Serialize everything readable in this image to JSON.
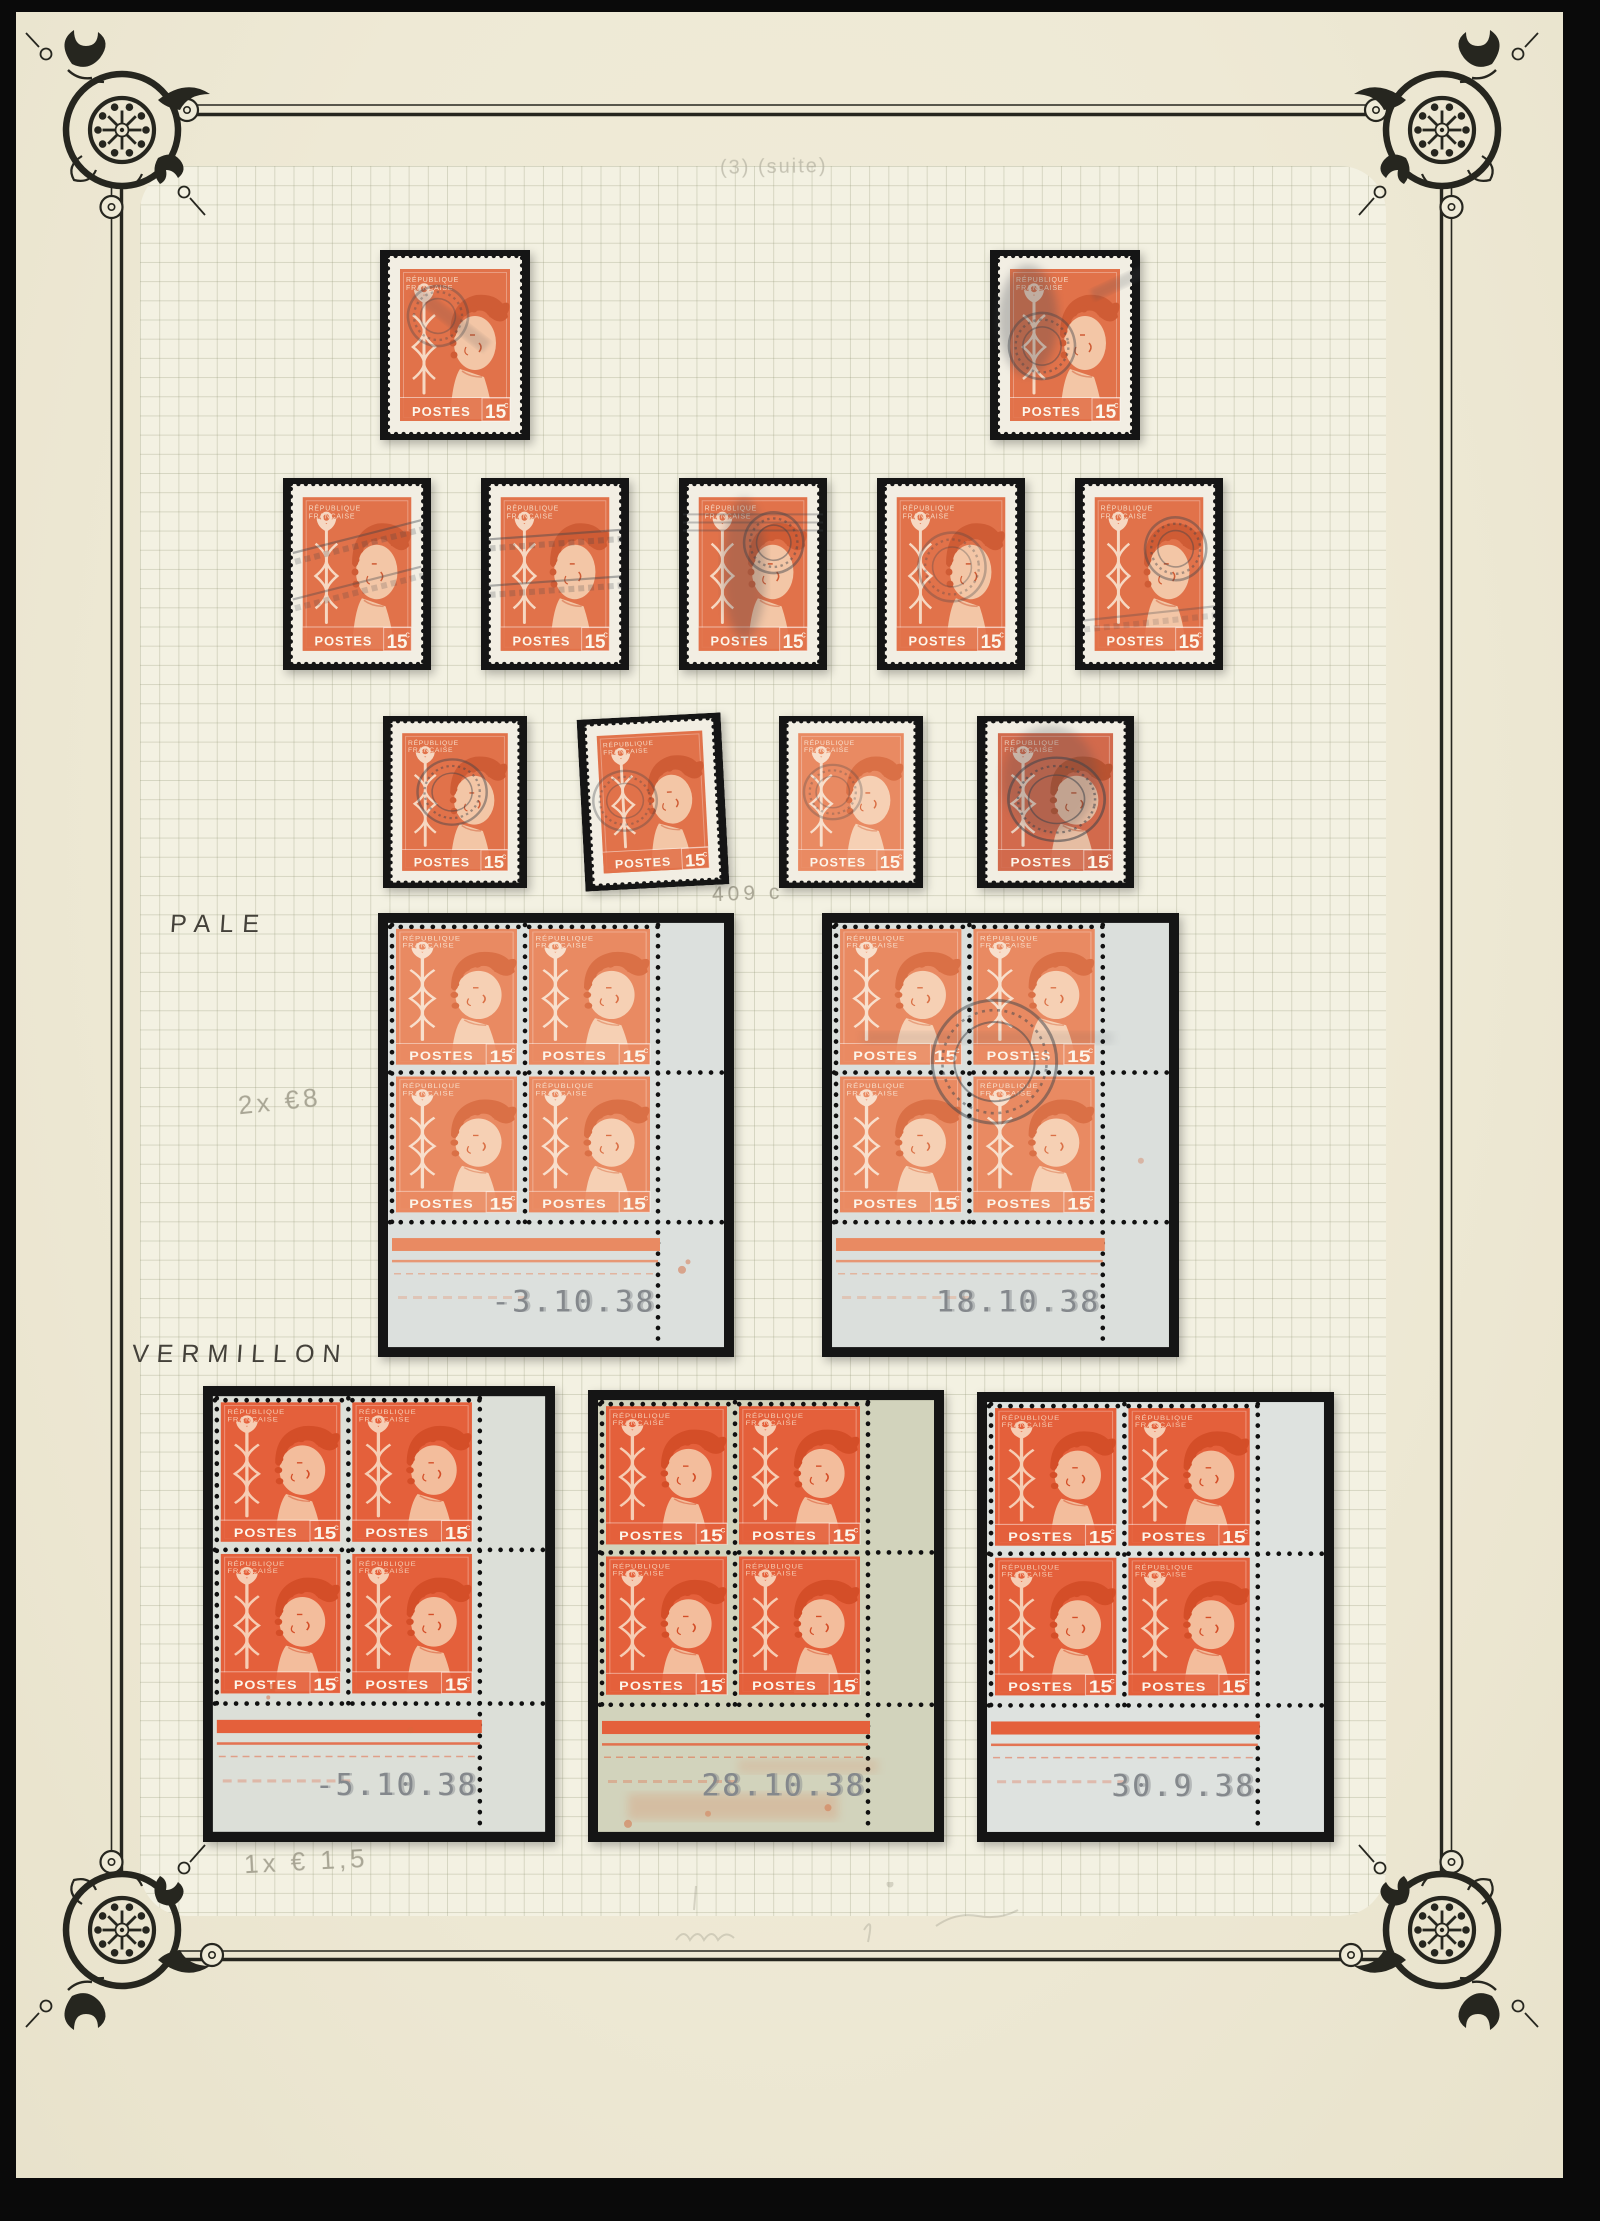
{
  "album": {
    "notes": {
      "top": "(3) (suite)",
      "catalog": "409 c",
      "pale_label": "PALE",
      "pale_price": "2x €8",
      "vermillon_label": "VERMILLON",
      "vermillon_price": "1x € 1,5"
    },
    "stamp_face": {
      "country1": "RÉPUBLIQUE",
      "country2": "FRANÇAISE",
      "postes": "POSTES",
      "value": "15",
      "unit": "c"
    },
    "colors": {
      "page": "#eeead7",
      "grid_paper": "#f3f1e2",
      "grid_line": "#c9c5ae",
      "mount": "#151515",
      "ink": "#26261f",
      "date_gray": "#84888c",
      "pencil": "#a19e8d",
      "single_paper": "#f2eee3",
      "shades": {
        "pale": {
          "o": "#e98a62",
          "l": "#f8dfcc",
          "s": "#f6d0b4",
          "d": "#da7046"
        },
        "normal": {
          "o": "#e1724a",
          "l": "#f6d8c2",
          "s": "#f3c6a6",
          "d": "#cf5c35"
        },
        "verm": {
          "o": "#e4603b",
          "l": "#f6cdb4",
          "s": "#f3bd9c",
          "d": "#d44e28"
        },
        "deep": {
          "o": "#d26a4c",
          "l": "#ead0be",
          "s": "#e6bda2",
          "d": "#b85331"
        }
      }
    },
    "singles": [
      {
        "x": 380,
        "y": 250,
        "w": 150,
        "h": 190,
        "shade": "normal",
        "tilt": 0,
        "cancels": [
          {
            "k": "cds",
            "x": 58,
            "y": 66,
            "r": 30,
            "o": 0.33,
            "rot": -20
          },
          {
            "k": "streak",
            "x": 40,
            "y": 36,
            "w": 90,
            "h": 14,
            "rot": 38,
            "o": 0.16
          }
        ]
      },
      {
        "x": 990,
        "y": 250,
        "w": 150,
        "h": 190,
        "shade": "normal",
        "tilt": 0,
        "cancels": [
          {
            "k": "smudge",
            "x": 38,
            "y": 70,
            "rx": 30,
            "ry": 55,
            "o": 0.3
          },
          {
            "k": "cds",
            "x": 52,
            "y": 96,
            "r": 33,
            "o": 0.42,
            "rot": -10
          },
          {
            "k": "streak",
            "x": 100,
            "y": 40,
            "w": 70,
            "h": 12,
            "rot": -25,
            "o": 0.18
          }
        ]
      },
      {
        "x": 283,
        "y": 478,
        "w": 148,
        "h": 192,
        "shade": "normal",
        "tilt": 0,
        "cancels": [
          {
            "k": "slogan",
            "y": 58,
            "rot": -14,
            "o": 0.4
          },
          {
            "k": "slogan",
            "y": 104,
            "rot": -14,
            "o": 0.35
          }
        ]
      },
      {
        "x": 481,
        "y": 478,
        "w": 148,
        "h": 192,
        "shade": "normal",
        "tilt": 0,
        "cancels": [
          {
            "k": "slogan",
            "y": 56,
            "rot": -4,
            "o": 0.42
          },
          {
            "k": "slogan",
            "y": 102,
            "rot": -4,
            "o": 0.4
          }
        ]
      },
      {
        "x": 679,
        "y": 478,
        "w": 148,
        "h": 192,
        "shade": "normal",
        "tilt": 0,
        "cancels": [
          {
            "k": "smudge",
            "x": 66,
            "y": 90,
            "rx": 22,
            "ry": 70,
            "o": 0.28
          },
          {
            "k": "cds",
            "x": 96,
            "y": 64,
            "r": 30,
            "o": 0.45,
            "rot": 10
          },
          {
            "k": "bars",
            "y": 36,
            "o": 0.3
          }
        ]
      },
      {
        "x": 877,
        "y": 478,
        "w": 148,
        "h": 192,
        "shade": "normal",
        "tilt": 0,
        "cancels": [
          {
            "k": "cds",
            "x": 76,
            "y": 88,
            "r": 34,
            "o": 0.3,
            "rot": -8
          }
        ]
      },
      {
        "x": 1075,
        "y": 478,
        "w": 148,
        "h": 192,
        "shade": "normal",
        "tilt": 0,
        "cancels": [
          {
            "k": "cds",
            "x": 102,
            "y": 70,
            "r": 31,
            "o": 0.42,
            "rot": 14
          },
          {
            "k": "slogan",
            "y": 134,
            "rot": -6,
            "o": 0.28
          }
        ]
      },
      {
        "x": 383,
        "y": 716,
        "w": 144,
        "h": 172,
        "shade": "normal",
        "tilt": 0,
        "cancels": [
          {
            "k": "cds",
            "x": 72,
            "y": 84,
            "r": 36,
            "o": 0.45,
            "rot": -5
          }
        ]
      },
      {
        "x": 581,
        "y": 716,
        "w": 144,
        "h": 172,
        "shade": "normal",
        "tilt": -3,
        "cancels": [
          {
            "k": "cds",
            "x": 46,
            "y": 92,
            "r": 33,
            "o": 0.33,
            "rot": -18
          }
        ]
      },
      {
        "x": 779,
        "y": 716,
        "w": 144,
        "h": 172,
        "shade": "pale",
        "tilt": 0,
        "cancels": [
          {
            "k": "cds",
            "x": 56,
            "y": 84,
            "r": 30,
            "o": 0.28,
            "rot": 0
          }
        ]
      },
      {
        "x": 977,
        "y": 716,
        "w": 157,
        "h": 172,
        "shade": "deep",
        "tilt": 0,
        "cancels": [
          {
            "k": "cds",
            "x": 76,
            "y": 92,
            "r": 46,
            "o": 0.55,
            "rot": 12
          },
          {
            "k": "smudge",
            "x": 70,
            "y": 70,
            "rx": 45,
            "ry": 60,
            "o": 0.22
          }
        ]
      }
    ],
    "blocks": [
      {
        "x": 378,
        "y": 913,
        "w": 356,
        "h": 444,
        "shade": "pale",
        "sheet": "#dce0dd",
        "date": "-3.10.38",
        "cancelled": false,
        "smear": false,
        "spots": [
          {
            "x": 304,
            "y": 360,
            "r": 4,
            "o": 0.5
          },
          {
            "x": 310,
            "y": 352,
            "r": 2.5,
            "o": 0.45
          }
        ]
      },
      {
        "x": 822,
        "y": 913,
        "w": 357,
        "h": 444,
        "shade": "pale",
        "sheet": "#dbdfdc",
        "date": "18.10.38",
        "cancelled": true,
        "smear": false,
        "spots": [
          {
            "x": 318,
            "y": 250,
            "r": 3,
            "o": 0.35
          }
        ]
      },
      {
        "x": 203,
        "y": 1386,
        "w": 352,
        "h": 456,
        "shade": "verm",
        "sheet": "#dcdfd8",
        "date": "-5.10.38",
        "cancelled": false,
        "smear": false,
        "spots": [
          {
            "x": 70,
            "y": 296,
            "r": 3.5,
            "o": 0.5
          },
          {
            "x": 210,
            "y": 338,
            "r": 3,
            "o": 0.4
          },
          {
            "x": 66,
            "y": 306,
            "r": 2,
            "o": 0.5
          }
        ]
      },
      {
        "x": 588,
        "y": 1390,
        "w": 356,
        "h": 452,
        "shade": "verm",
        "sheet": "#d2d3bc",
        "date": "28.10.38",
        "cancelled": false,
        "smear": true,
        "spots": [
          {
            "x": 40,
            "y": 430,
            "r": 4,
            "o": 0.5
          },
          {
            "x": 120,
            "y": 420,
            "r": 3,
            "o": 0.4
          },
          {
            "x": 240,
            "y": 414,
            "r": 3.5,
            "o": 0.45
          }
        ]
      },
      {
        "x": 977,
        "y": 1392,
        "w": 357,
        "h": 450,
        "shade": "verm",
        "sheet": "#dee2df",
        "date": "30.9.38",
        "cancelled": false,
        "smear": false,
        "spots": []
      }
    ]
  }
}
